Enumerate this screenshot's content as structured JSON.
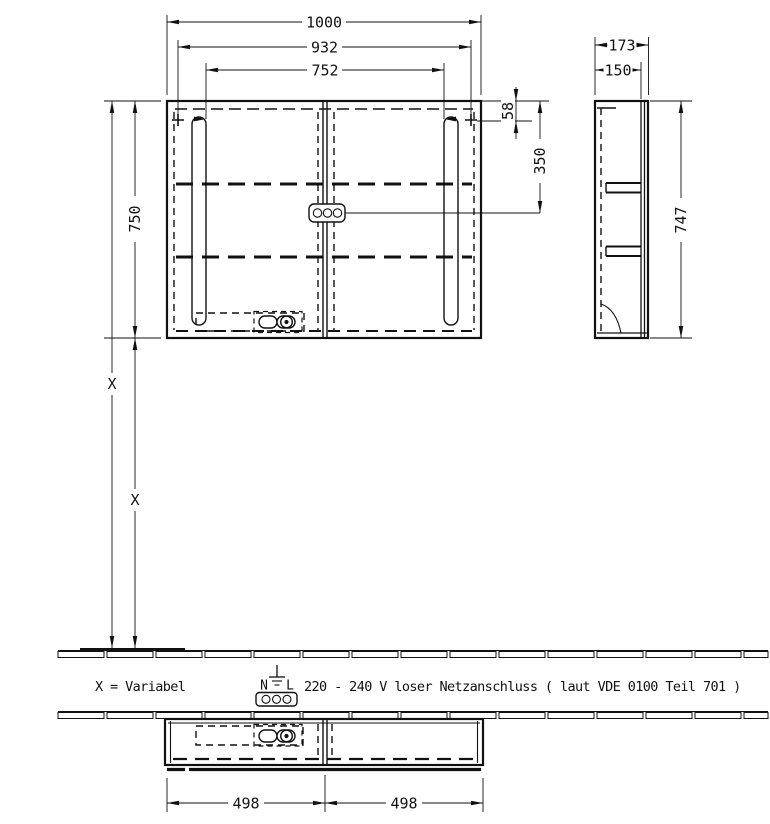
{
  "dims": {
    "front": {
      "overall_width": "1000",
      "mounting_width": "932",
      "lights_spacing": "752",
      "height": "750",
      "mount_offset": "58",
      "socket_offset": "350",
      "wall_upper": "X",
      "wall_lower": "X"
    },
    "side": {
      "depth": "173",
      "body_depth": "150",
      "height": "747"
    },
    "bottom": {
      "left_half": "498",
      "right_half": "498"
    }
  },
  "notes": {
    "variable": "X = Variabel",
    "power": "220 - 240 V loser Netzanschluss ( laut VDE 0100 Teil 701 )"
  },
  "electrical": {
    "neutral": "N",
    "line": "L"
  },
  "colors": {
    "line": "#111111",
    "background": "#ffffff"
  }
}
